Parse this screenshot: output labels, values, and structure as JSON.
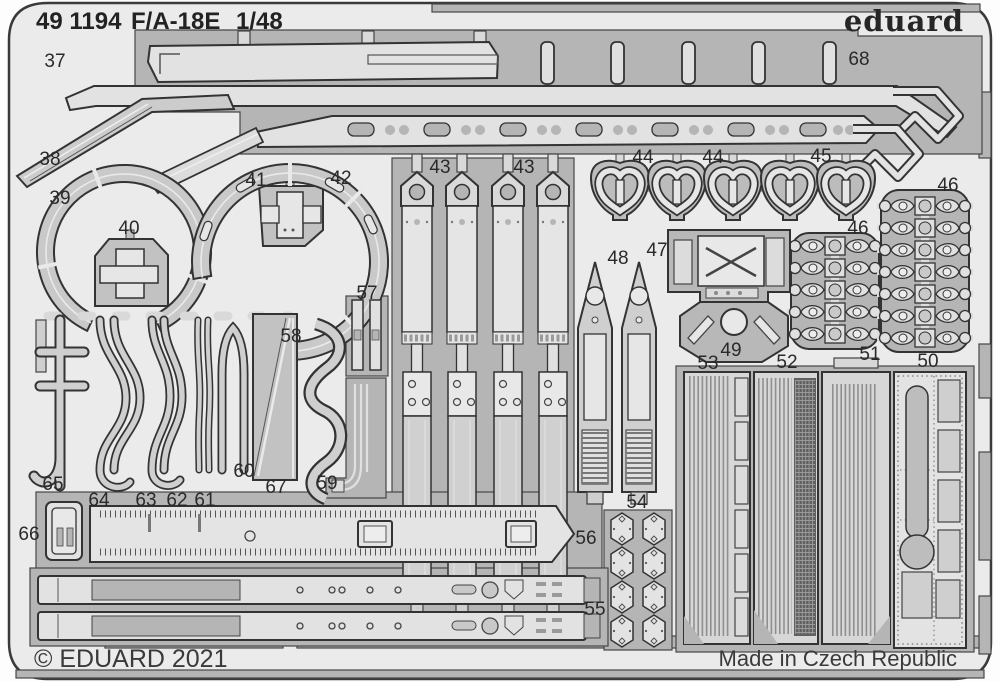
{
  "header": {
    "catalog_number": "49 1194",
    "aircraft": "F/A-18E",
    "scale": "1/48",
    "brand_logo": "eduard"
  },
  "footer": {
    "copyright": "© EDUARD 2021",
    "made_in": "Made in Czech Republic"
  },
  "colors": {
    "plate_web": "#b5b5b5",
    "interior": "#ebebeb",
    "part_light": "#e2e2e2",
    "part_mid": "#c9c9c9",
    "outline": "#333333",
    "label_text": "#2a2a2a"
  },
  "parts": [
    {
      "label": "37",
      "x": 55,
      "y": 67
    },
    {
      "label": "38",
      "x": 50,
      "y": 165
    },
    {
      "label": "39",
      "x": 60,
      "y": 204
    },
    {
      "label": "40",
      "x": 129,
      "y": 234
    },
    {
      "label": "41",
      "x": 256,
      "y": 186
    },
    {
      "label": "42",
      "x": 341,
      "y": 184
    },
    {
      "label": "43",
      "x": 440,
      "y": 173
    },
    {
      "label": "43",
      "x": 524,
      "y": 173
    },
    {
      "label": "44",
      "x": 643,
      "y": 163
    },
    {
      "label": "44",
      "x": 713,
      "y": 163
    },
    {
      "label": "45",
      "x": 821,
      "y": 162
    },
    {
      "label": "46",
      "x": 858,
      "y": 234
    },
    {
      "label": "46",
      "x": 948,
      "y": 191
    },
    {
      "label": "47",
      "x": 657,
      "y": 256
    },
    {
      "label": "48",
      "x": 618,
      "y": 264
    },
    {
      "label": "49",
      "x": 731,
      "y": 356
    },
    {
      "label": "50",
      "x": 928,
      "y": 367
    },
    {
      "label": "51",
      "x": 870,
      "y": 360
    },
    {
      "label": "52",
      "x": 787,
      "y": 368
    },
    {
      "label": "53",
      "x": 708,
      "y": 369
    },
    {
      "label": "54",
      "x": 637,
      "y": 508
    },
    {
      "label": "55",
      "x": 595,
      "y": 615
    },
    {
      "label": "56",
      "x": 586,
      "y": 544
    },
    {
      "label": "57",
      "x": 367,
      "y": 299
    },
    {
      "label": "58",
      "x": 291,
      "y": 342
    },
    {
      "label": "59",
      "x": 327,
      "y": 489
    },
    {
      "label": "60",
      "x": 244,
      "y": 477
    },
    {
      "label": "61",
      "x": 205,
      "y": 506
    },
    {
      "label": "62",
      "x": 177,
      "y": 506
    },
    {
      "label": "63",
      "x": 146,
      "y": 506
    },
    {
      "label": "64",
      "x": 99,
      "y": 506
    },
    {
      "label": "65",
      "x": 53,
      "y": 490
    },
    {
      "label": "66",
      "x": 29,
      "y": 540
    },
    {
      "label": "67",
      "x": 276,
      "y": 493
    },
    {
      "label": "68",
      "x": 859,
      "y": 65
    }
  ]
}
